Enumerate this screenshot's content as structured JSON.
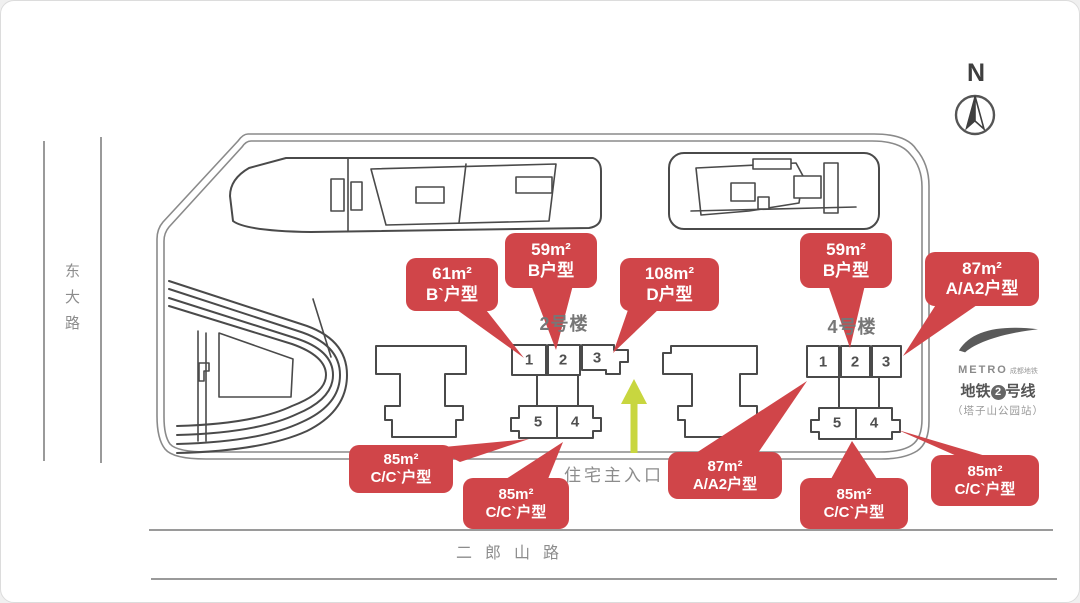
{
  "compass": {
    "label": "N"
  },
  "roads": {
    "west": "东大路",
    "south": "二郎山路"
  },
  "entrance": {
    "label": "住宅主入口"
  },
  "buildings": [
    {
      "name": "2号楼",
      "units": [
        "1",
        "2",
        "3",
        "5",
        "4"
      ]
    },
    {
      "name": "4号楼",
      "units": [
        "1",
        "2",
        "3",
        "5",
        "4"
      ]
    }
  ],
  "callouts": [
    {
      "area": "61m²",
      "type": "B`户型"
    },
    {
      "area": "59m²",
      "type": "B户型"
    },
    {
      "area": "108m²",
      "type": "D户型"
    },
    {
      "area": "59m²",
      "type": "B户型"
    },
    {
      "area": "87m²",
      "type": "A/A2户型"
    },
    {
      "area": "85m²",
      "type": "C/C`户型"
    },
    {
      "area": "85m²",
      "type": "C/C`户型"
    },
    {
      "area": "87m²",
      "type": "A/A2户型"
    },
    {
      "area": "85m²",
      "type": "C/C`户型"
    },
    {
      "area": "85m²",
      "type": "C/C`户型"
    }
  ],
  "metro": {
    "brand": "METRO",
    "brand_sub": "成都地铁",
    "line_prefix": "地铁",
    "line_number": "2",
    "line_suffix": "号线",
    "station": "（塔子山公园站）"
  },
  "colors": {
    "callout_red": "#d04549",
    "arrow_green": "#c8d63f",
    "line_dark": "#4a4a4a",
    "road_gray": "#9a9a9a",
    "text_gray": "#8c8c8c"
  }
}
